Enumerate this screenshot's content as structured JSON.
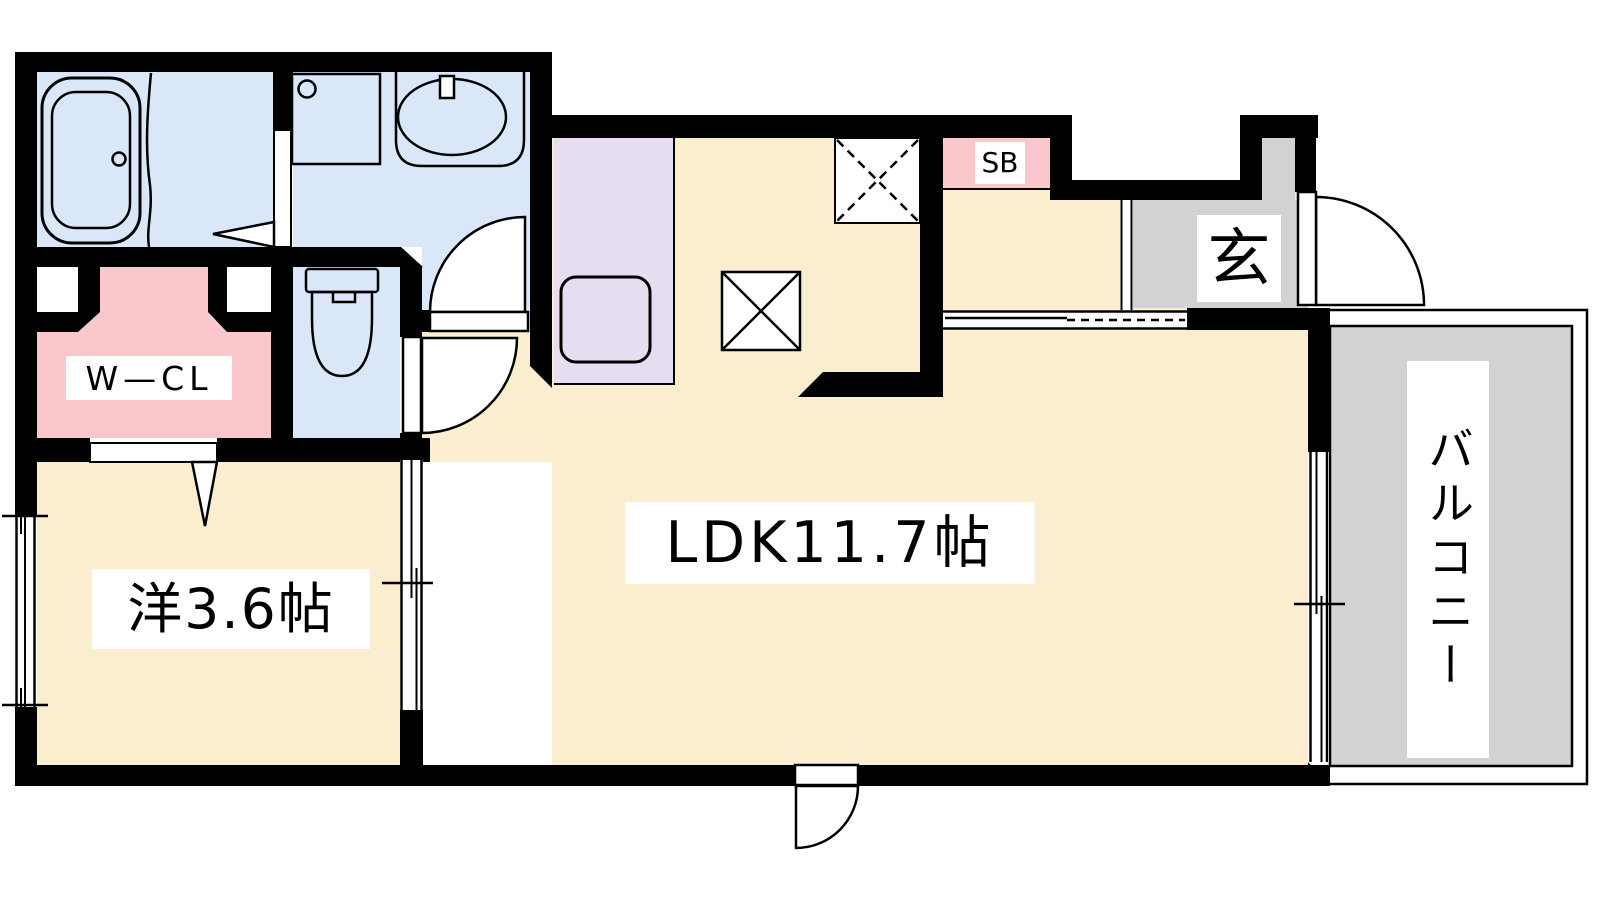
{
  "plan_type": "apartment-floor-plan",
  "rooms": {
    "ldk": {
      "label": "LDK11.7帖",
      "type": "living-dining-kitchen"
    },
    "western": {
      "label": "洋3.6帖",
      "type": "western-style-room"
    },
    "wcl": {
      "label": "W—CL",
      "type": "walk-in-closet"
    },
    "entrance": {
      "label": "玄",
      "type": "genkan-entrance"
    },
    "shoebox": {
      "label": "SB",
      "type": "shoe-box"
    },
    "balcony": {
      "label": "バルコニー",
      "type": "balcony"
    },
    "bathroom": {
      "label": "",
      "type": "unit-bath"
    },
    "washroom": {
      "label": "",
      "type": "washroom"
    },
    "toilet": {
      "label": "",
      "type": "toilet"
    },
    "kitchen": {
      "label": "",
      "type": "kitchen"
    }
  },
  "colors": {
    "wall": "#000000",
    "bg": "#FFFFFF",
    "room_cream": "#FBEECF",
    "water_blue": "#D9E7F8",
    "closet_pink": "#FAC8CC",
    "kitchen_lavender": "#E7DDF3",
    "tile_gray": "#D2D2D2",
    "line": "#000000"
  }
}
